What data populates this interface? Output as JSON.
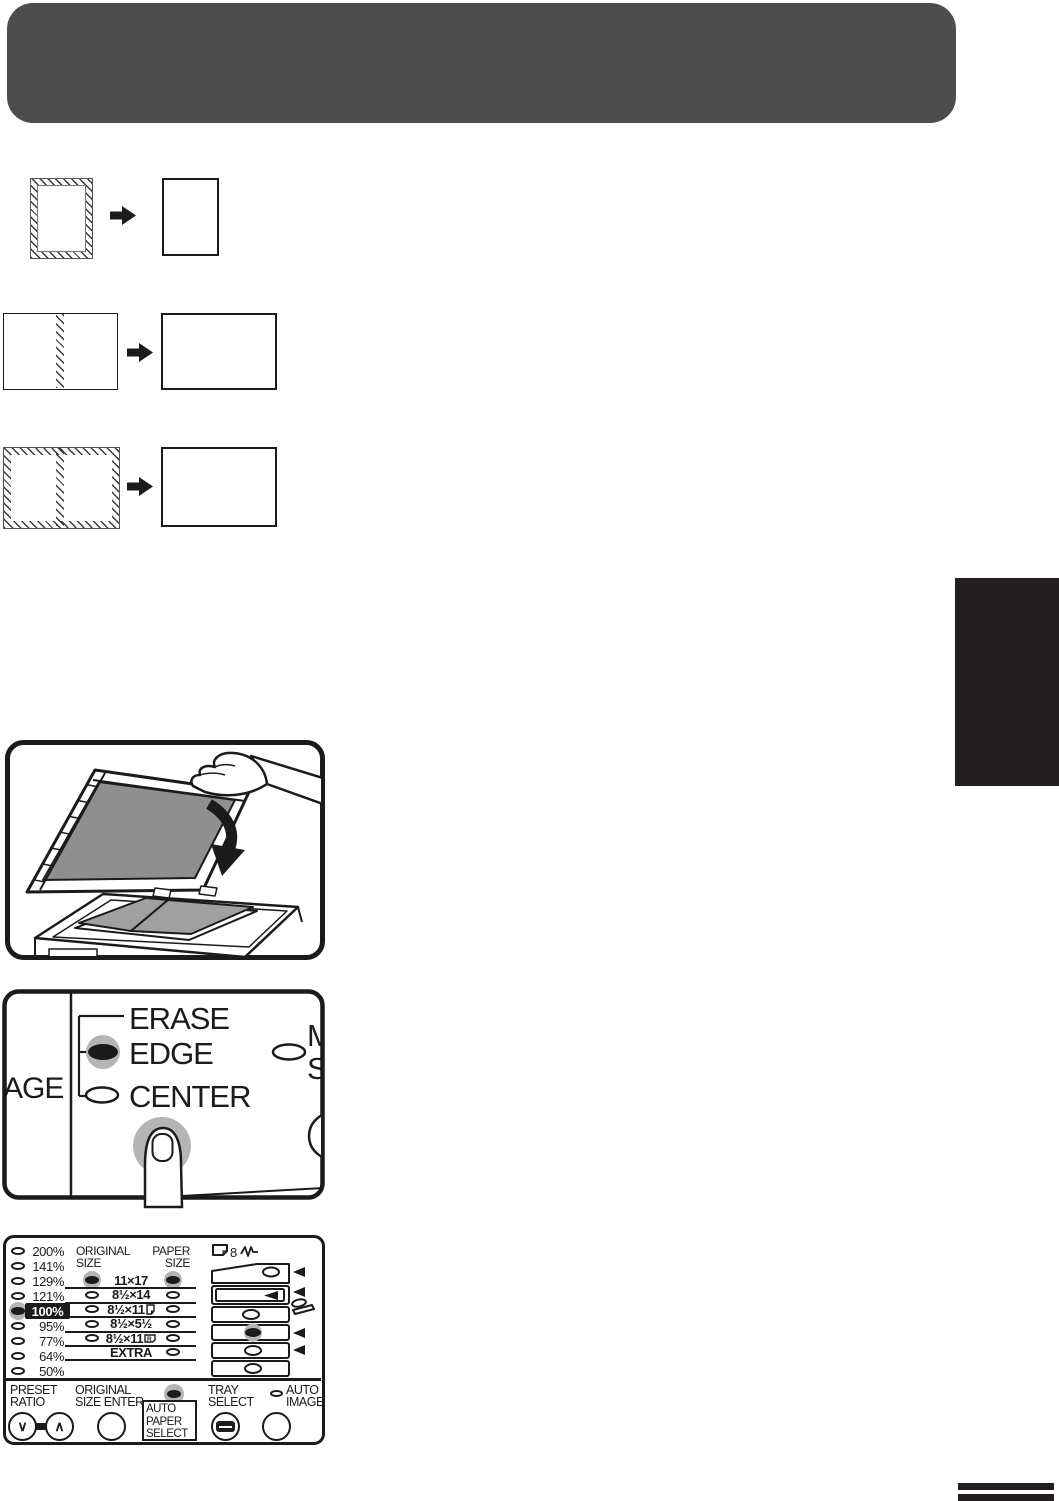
{
  "page": {
    "background": "#ffffff"
  },
  "header_bar": {
    "color": "#4d4d4d"
  },
  "section_tab": {
    "color": "#231f20"
  },
  "copy_diagrams": [
    {
      "original": "portrait-page-hatched-border",
      "result": "portrait-page-plain"
    },
    {
      "original": "landscape-page-hatched-center-strip",
      "result": "landscape-page-plain"
    },
    {
      "original": "landscape-page-hatched-border-and-center",
      "result": "landscape-page-plain"
    }
  ],
  "illustration_panel": {
    "description": "copier-with-open-document-cover-book-on-glass"
  },
  "erase_panel": {
    "left_partial_label": "AGE",
    "erase_label": "ERASE",
    "edge_label": "EDGE",
    "center_label": "CENTER",
    "edge_led": "on",
    "center_led": "off",
    "right_partial_label_top": "M",
    "right_partial_label_bottom": "S"
  },
  "ratio_panel": {
    "preset_ratios": [
      {
        "label": "200%",
        "led": "off"
      },
      {
        "label": "141%",
        "led": "off"
      },
      {
        "label": "129%",
        "led": "off"
      },
      {
        "label": "121%",
        "led": "off"
      },
      {
        "label": "100%",
        "led": "on",
        "highlighted": true
      },
      {
        "label": "95%",
        "led": "off"
      },
      {
        "label": "77%",
        "led": "off"
      },
      {
        "label": "64%",
        "led": "off"
      },
      {
        "label": "50%",
        "led": "off"
      }
    ],
    "original_size_header_line1": "ORIGINAL",
    "original_size_header_line2": "SIZE",
    "paper_size_header_line1": "PAPER",
    "paper_size_header_line2": "SIZE",
    "size_rows": [
      {
        "label": "11×17",
        "original_led": "on",
        "paper_led": "on"
      },
      {
        "label": "8½×14",
        "original_led": "off",
        "paper_led": "off"
      },
      {
        "label": "8½×11",
        "icon": "portrait-page",
        "original_led": "off",
        "paper_led": "off"
      },
      {
        "label": "8½×5½",
        "original_led": "off",
        "paper_led": "off"
      },
      {
        "label": "8½×11",
        "icon": "landscape-page-r",
        "icon_letter": "R",
        "original_led": "off",
        "paper_led": "off"
      },
      {
        "label": "EXTRA",
        "paper_led": "off"
      }
    ],
    "tray_diagram": {
      "eight_label": "8",
      "selected_tray_led": "on"
    },
    "controls": {
      "preset_ratio": {
        "line1": "PRESET",
        "line2": "RATIO",
        "down_glyph": "∨",
        "up_glyph": "∧"
      },
      "original_size_enter": {
        "line1": "ORIGINAL",
        "line2": "SIZE ENTER"
      },
      "auto_paper_select": {
        "line1": "AUTO",
        "line2": "PAPER",
        "line3": "SELECT",
        "led": "on"
      },
      "tray_select": {
        "line1": "TRAY",
        "line2": "SELECT"
      },
      "auto_image": {
        "line1": "AUTO",
        "line2": "IMAGE",
        "led": "off"
      }
    }
  }
}
